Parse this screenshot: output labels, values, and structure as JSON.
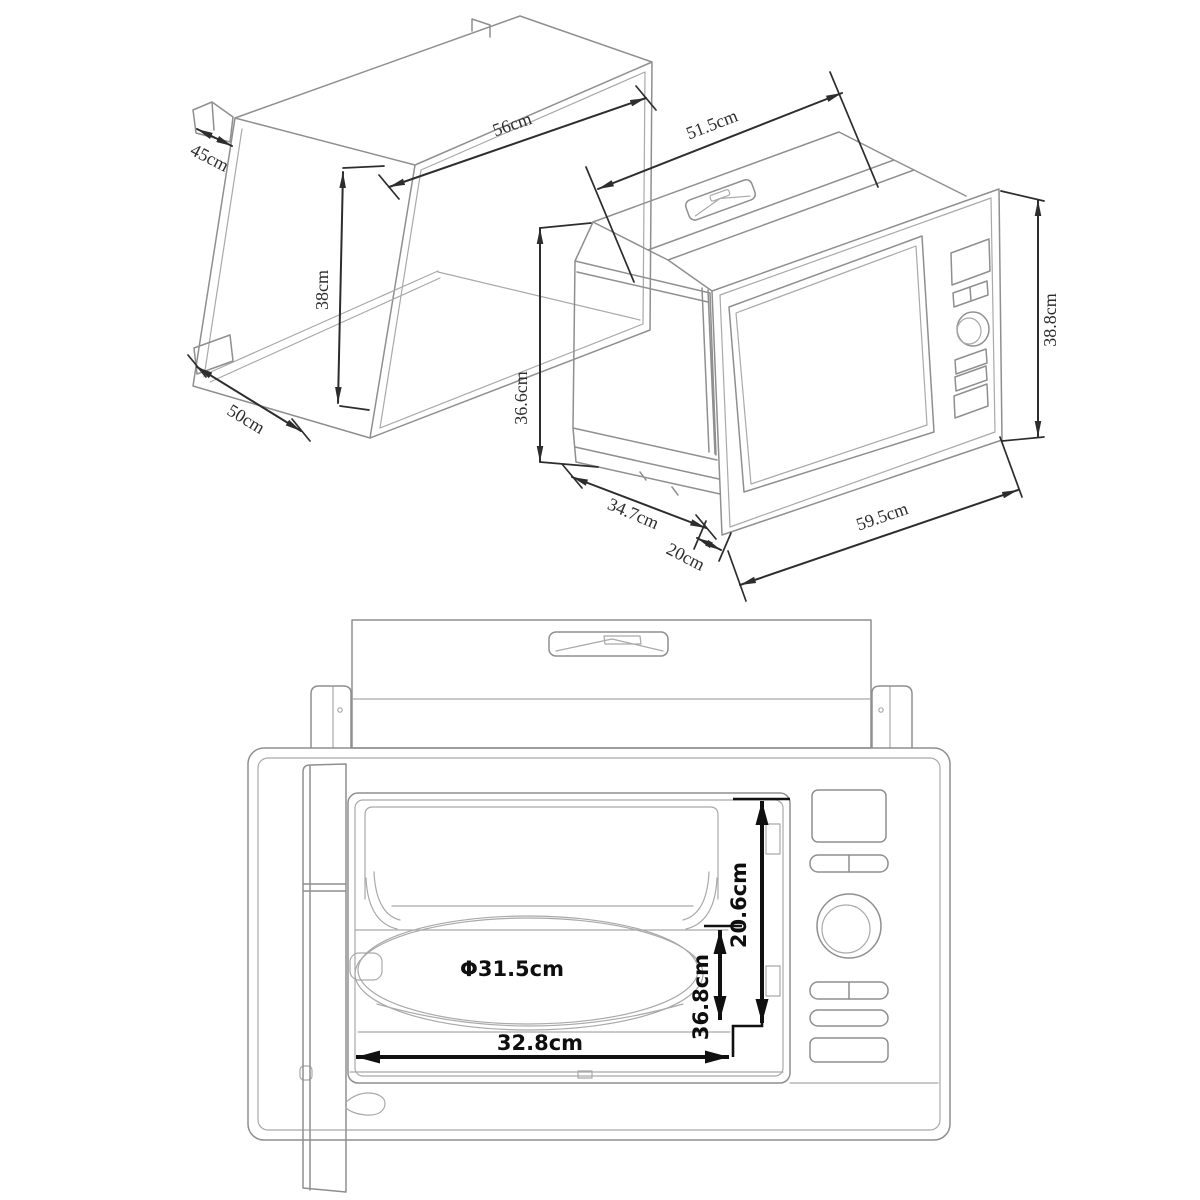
{
  "views": {
    "cabinet": {
      "dims": {
        "top_depth": "45cm",
        "width": "56cm",
        "height": "38cm",
        "bottom_depth": "50cm"
      }
    },
    "microwave_iso": {
      "dims": {
        "width": "51.5cm",
        "height": "36.6cm",
        "depth": "34.7cm",
        "clearance": "20cm",
        "frame_width": "59.5cm",
        "frame_height": "38.8cm"
      }
    },
    "front": {
      "dims": {
        "cavity_height": "20.6cm",
        "inner_height": "36.8cm",
        "cavity_width": "32.8cm",
        "turntable_diameter": "Φ31.5cm"
      }
    }
  }
}
